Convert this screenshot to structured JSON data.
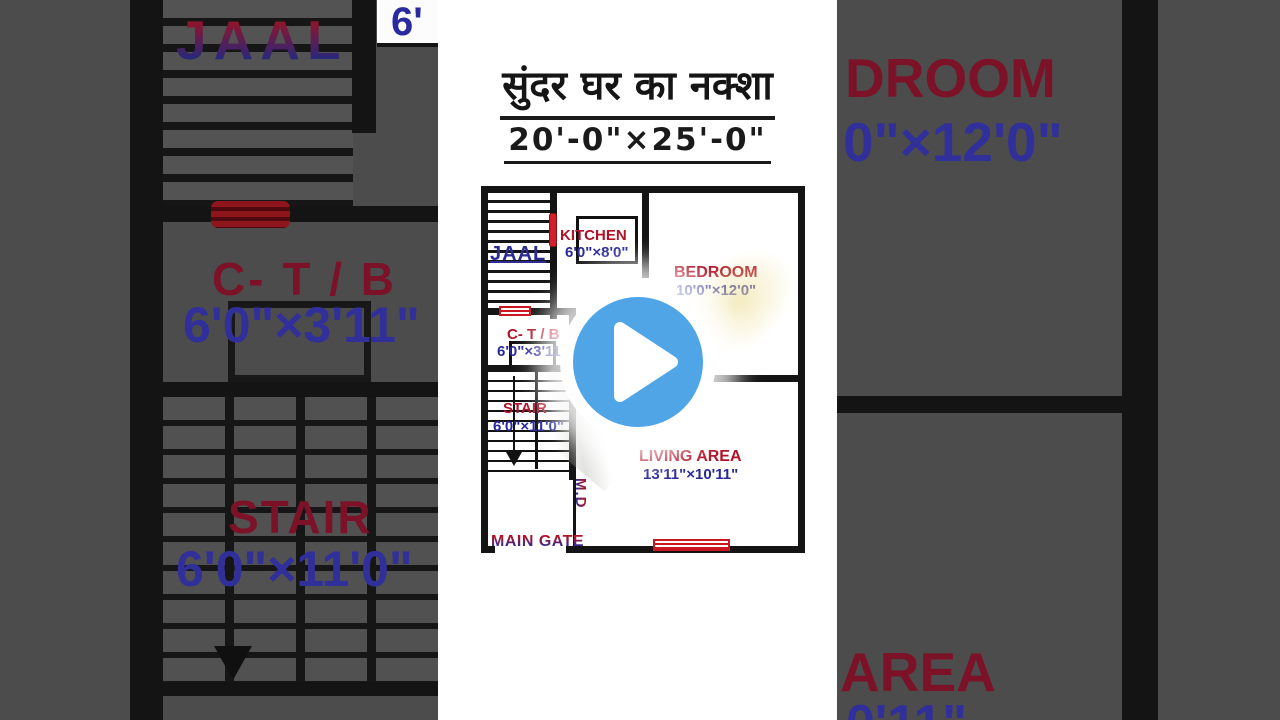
{
  "header": {
    "title": "सुंदर घर का नक्शा",
    "plot_size": "20'-0\"×25'-0\""
  },
  "plan": {
    "jaal": {
      "label": "JAAL"
    },
    "kitchen": {
      "label": "KITCHEN",
      "dims": "6'0\"×8'0\""
    },
    "bedroom": {
      "label": "BEDROOM",
      "dims": "10'0\"×12'0\""
    },
    "ctb": {
      "label": "C- T / B",
      "dims": "6'0\"×3'11\""
    },
    "stair": {
      "label": "STAIR",
      "dims": "6'0\"×11'0\""
    },
    "living": {
      "label": "LIVING AREA",
      "dims": "13'11\"×10'11\""
    },
    "md": {
      "label": "M.D"
    },
    "main_gate": {
      "label": "MAIN GATE"
    }
  },
  "background": {
    "left": {
      "jaal": "JAAL",
      "kitchen_dim_fragment": "6'",
      "ctb": "C- T / B",
      "ctb_dims": "6'0\"×3'11\"",
      "stair": "STAIR",
      "stair_dims": "6'0\"×11'0\""
    },
    "right": {
      "bedroom_fragment": "DROOM",
      "bedroom_dims_fragment": "0\"×12'0\"",
      "living_fragment": "AREA",
      "living_dims_fragment": "0'11\""
    }
  },
  "player": {
    "play_icon": "play-triangle"
  },
  "colors": {
    "label_red": "#b11226",
    "dim_blue": "#28289a",
    "wall_black": "#141414",
    "play_blue": "#50a5e6",
    "bg_gray": "#4c4c4c",
    "panel_white": "#ffffff"
  }
}
